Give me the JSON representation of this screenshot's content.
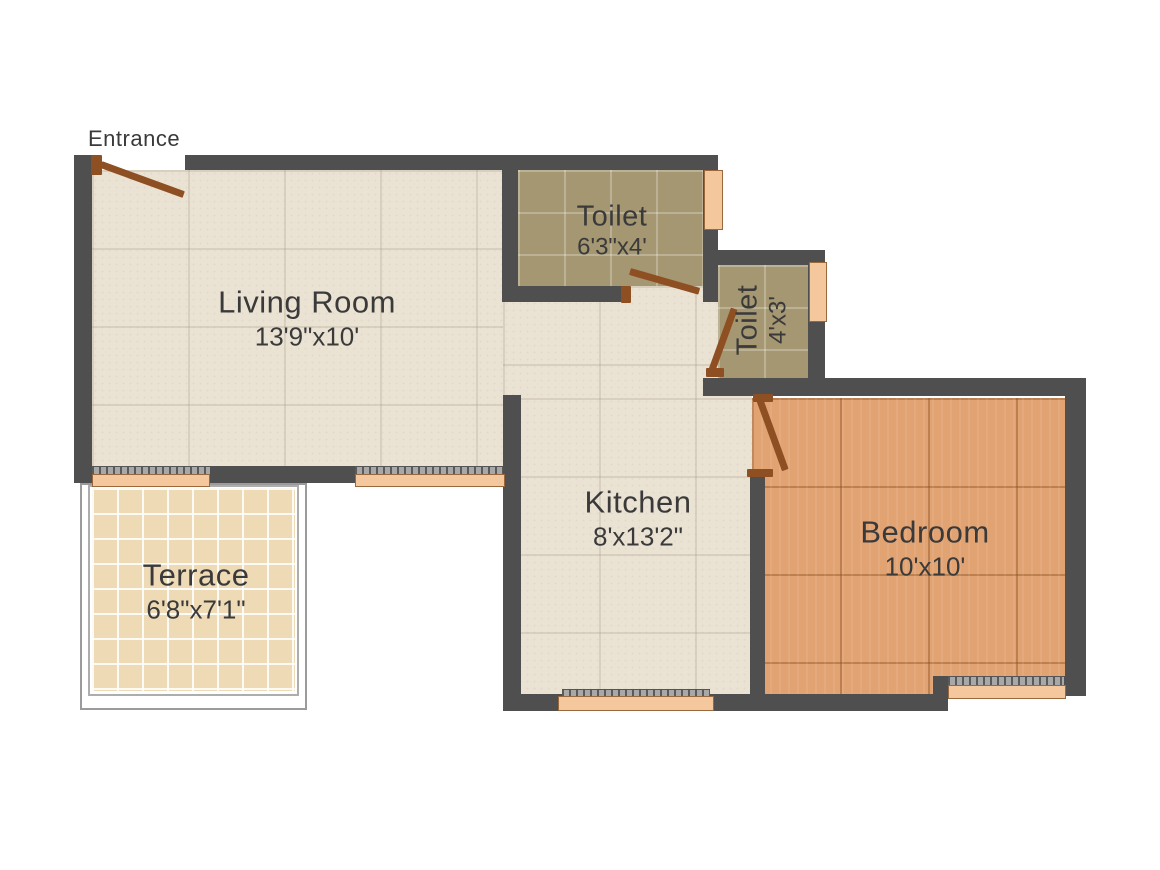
{
  "plan": {
    "entrance_label": "Entrance",
    "rooms": {
      "living_room": {
        "name": "Living Room",
        "dimensions": "13'9\"x10'"
      },
      "toilet_main": {
        "name": "Toilet",
        "dimensions": "6'3\"x4'"
      },
      "toilet_small": {
        "name": "Toilet",
        "dimensions": "4'x3'"
      },
      "kitchen": {
        "name": "Kitchen",
        "dimensions": "8'x13'2\""
      },
      "bedroom": {
        "name": "Bedroom",
        "dimensions": "10'x10'"
      },
      "terrace": {
        "name": "Terrace",
        "dimensions": "6'8\"x7'1\""
      }
    },
    "colors": {
      "background": "#ffffff",
      "wall": "#4f4f4f",
      "floor_living_kitchen": "#eae2d3",
      "floor_toilet": "#a49771",
      "floor_bedroom": "#e2a372",
      "floor_terrace": "#eedbb6",
      "window_pane": "#f4c79c",
      "window_sill": "#a8a8a8",
      "door": "#8e4f22",
      "text": "#3a3a3a"
    }
  }
}
